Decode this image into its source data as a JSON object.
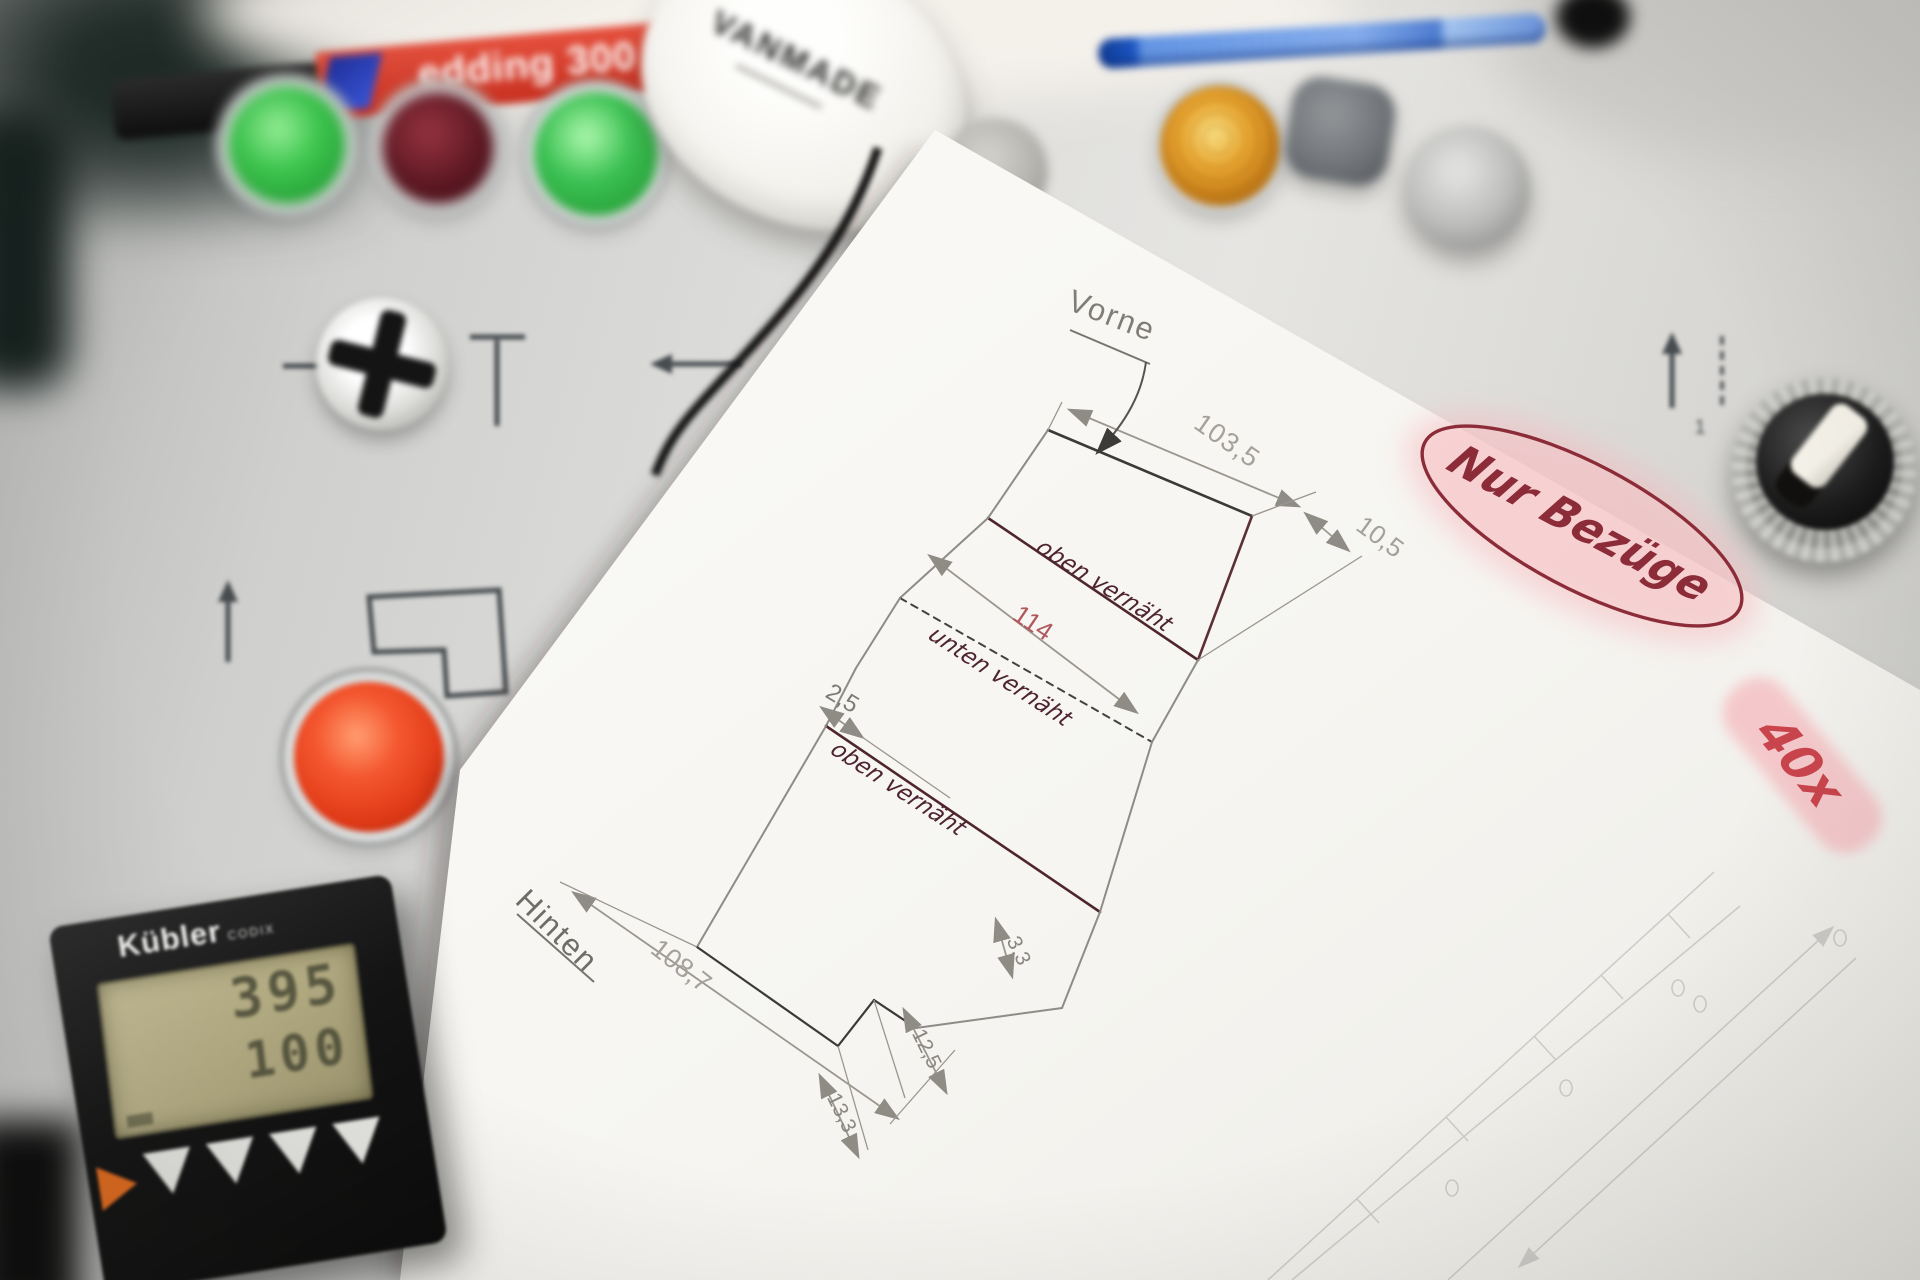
{
  "panel": {
    "marking_selector": "1",
    "base_color": "#d9d9d6",
    "print_color": "#474c4f"
  },
  "marker": {
    "brand_text": "edding 300",
    "body_color": "#d43a2a",
    "cap_color": "#141414",
    "logo_color": "#2b3fb3"
  },
  "tape_measure": {
    "brand_text": "VANMADE",
    "body_color": "#fbfaf7"
  },
  "pen": {
    "body_color": "#2f6fd6"
  },
  "counter": {
    "brand_text": "Kübler",
    "series_text": "CODIX",
    "display_top": "395",
    "display_bottom": "100",
    "lcd_color": "#b5ad84",
    "body_color": "#181818",
    "accent_color": "#e06a1e"
  },
  "buttons": {
    "green": "#3ec74f",
    "dark_red": "#5c1822",
    "red": "#e8452c",
    "amber": "#e0a02a",
    "silver": "#c9c9c7",
    "gray": "#72767a"
  },
  "paper": {
    "label_front": "Vorne",
    "label_back": "Hinten",
    "dim_top_edge": "103,5",
    "dim_top_small": "10,5",
    "dim_seam": "114",
    "dim_step": "2,5",
    "dim_bottom_edge": "108,7",
    "dim_b1": "12,5",
    "dim_b2": "13,3",
    "dim_b3": "3,3",
    "hw_seam_top": "oben vernäht",
    "hw_seam_bottom": "unten vernäht",
    "hw_seam_top2": "oben vernäht",
    "note_circled": "Nur Bezüge",
    "note_quantity": "40x",
    "ink_color": "#4e2433",
    "note_color": "#8c2c38",
    "dim_color": "#a5a19a",
    "dim_red_color": "#b0585e",
    "highlight_color": "#f6b9bd"
  }
}
